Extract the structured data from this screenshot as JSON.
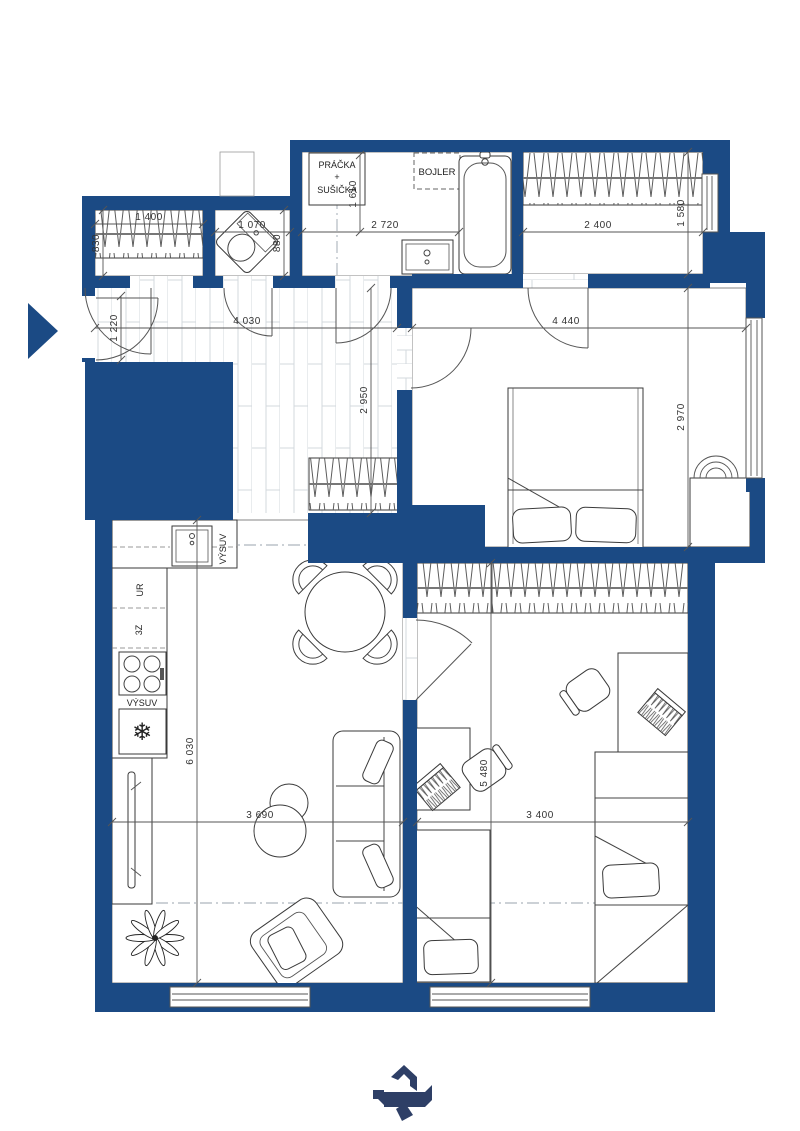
{
  "plan": {
    "type": "apartment-floor-plan",
    "labels": {
      "washer_line1": "PRÁČKA",
      "washer_line2": "+",
      "washer_line3": "SUŠIČKA",
      "boiler": "BOJLER",
      "pullout_sink": "VÝSUV",
      "cabinet_ur": "UR",
      "cabinet_3z": "3Z",
      "pullout_stove": "VÝSUV"
    },
    "icons": {
      "freezer_glyph": "❄",
      "entrance_arrow": "entrance-direction-arrow",
      "logo": "brand-logo-mark"
    },
    "dims": {
      "closet_w": "1 400",
      "closet_d": "830",
      "wc_w": "1 070",
      "wc_d": "880",
      "bath_w": "2 720",
      "bath_d": "1 610",
      "nook_w": "2 400",
      "nook_d": "1 580",
      "entry_w": "1 220",
      "hall_w": "4 030",
      "hall_l": "2 950",
      "bedroom_w": "4 440",
      "bedroom_d": "2 970",
      "living_l": "6 030",
      "living_w": "3 690",
      "kids_l": "5 480",
      "kids_w": "3 400"
    },
    "colors": {
      "wall": "#1b4a84",
      "tile": "#d9d9d9",
      "floor_line": "#d3d8de",
      "line": "#3a3a3a",
      "dim": "#444444",
      "logo": "#2e3f66"
    }
  }
}
